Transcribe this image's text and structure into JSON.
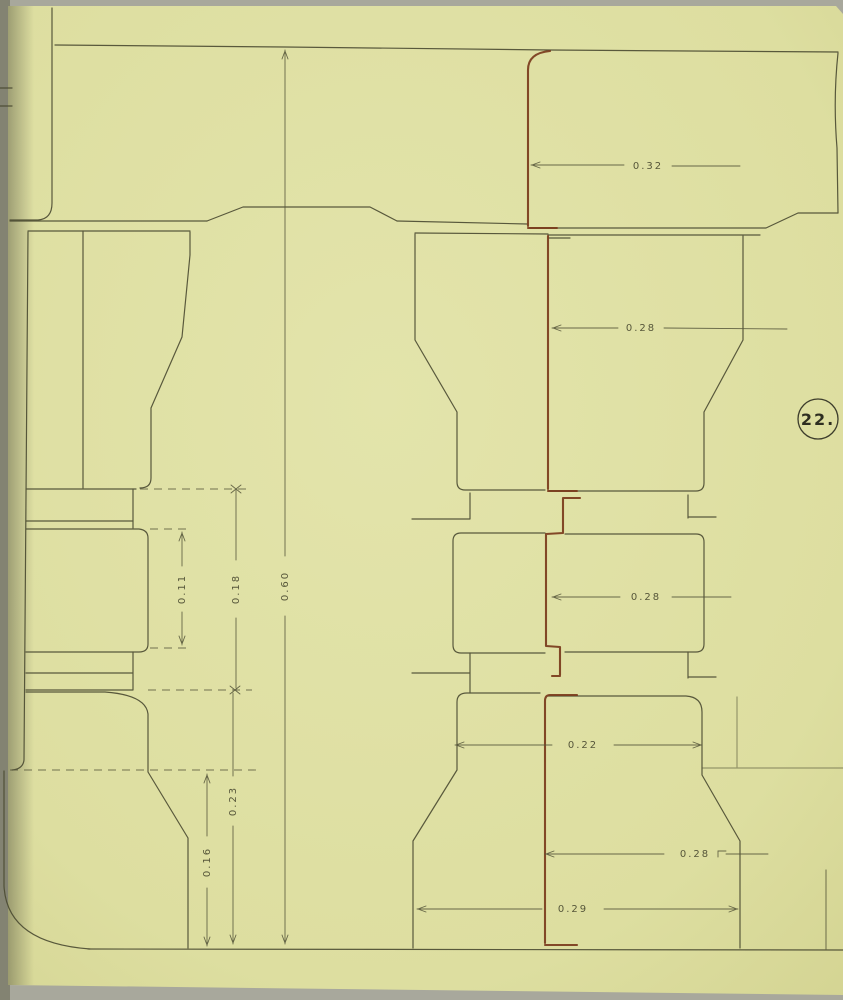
{
  "document": {
    "type": "engineering-drawing",
    "description": "Ink drawing of interlocking mast sections with scarf joints on aged yellow paper",
    "plate_number": "22."
  },
  "palette": {
    "paper": "#e0e1a6",
    "paper_dark": "#d5d592",
    "ink": "#4a4a31",
    "accent_ink": "#7a3b1c",
    "dim_ink": "#56563a",
    "backdrop": "#a8a89c"
  },
  "dimension_labels": [
    {
      "id": "dim-top-width",
      "text": "0.32",
      "orientation": "horizontal"
    },
    {
      "id": "dim-upper-width",
      "text": "0.28",
      "orientation": "horizontal"
    },
    {
      "id": "dim-middle-width",
      "text": "0.28",
      "orientation": "horizontal"
    },
    {
      "id": "dim-lower-neck-width",
      "text": "0.22",
      "orientation": "horizontal"
    },
    {
      "id": "dim-lower-width",
      "text": "0.28",
      "orientation": "horizontal"
    },
    {
      "id": "dim-base-width",
      "text": "0.29",
      "orientation": "horizontal"
    },
    {
      "id": "dim-inner-height",
      "text": "0.11",
      "orientation": "vertical"
    },
    {
      "id": "dim-joint-height",
      "text": "0.18",
      "orientation": "vertical"
    },
    {
      "id": "dim-overall-height",
      "text": "0.60",
      "orientation": "vertical"
    },
    {
      "id": "dim-foot-height",
      "text": "0.16",
      "orientation": "vertical"
    },
    {
      "id": "dim-base-height",
      "text": "0.23",
      "orientation": "vertical"
    }
  ],
  "plate_badge": {
    "text": "22."
  }
}
